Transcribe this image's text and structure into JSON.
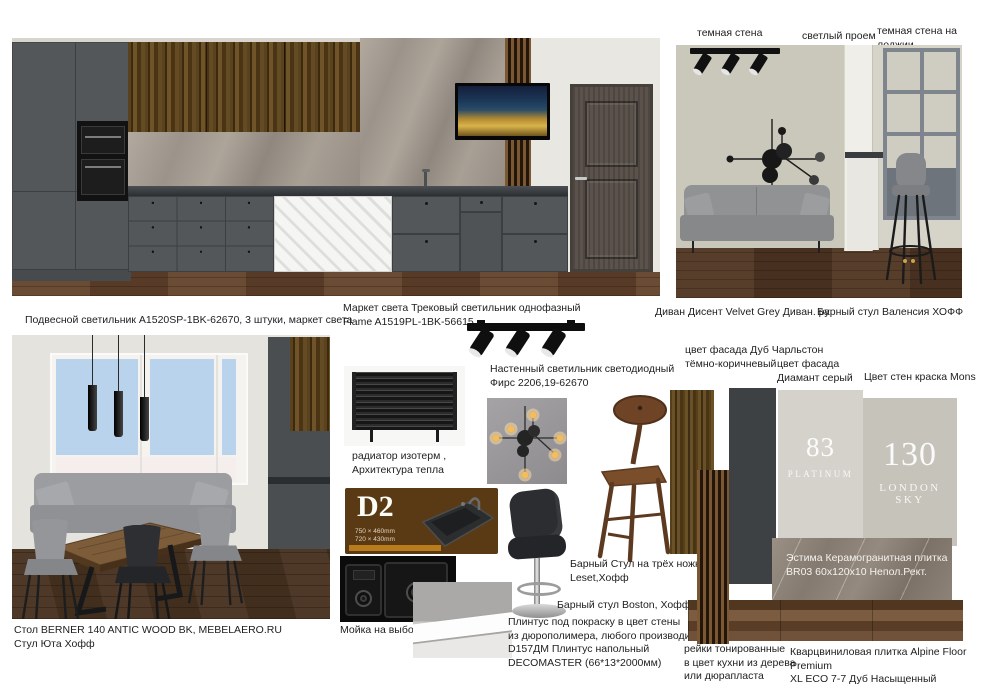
{
  "annotations": {
    "dark_wall": "темная стена",
    "light_opening": "светлый проем",
    "dark_wall_loggia": "темная стена на лоджии"
  },
  "captions": {
    "pendant_light": "Подвесной светильник A1520SP-1BK-62670, 3 штуки, маркет света",
    "track_light": "Маркет света Трековый светильник однофазный\nFlame A1519PL-1BK-56615",
    "sofa": "Диван Дисент Velvet Grey Диван. ру",
    "stool_valencia": "Барный стул Валенсия  ХОФФ",
    "wall_light": "Настенный светильник светодиодный\nФирс 2206,19-62670",
    "radiator": "радиатор изотерм ,\nАрхитектура тепла",
    "sink": "Мойка на выбор",
    "stool_leset": "Барный Стул на трёх ножках\nLeset,Хофф",
    "stool_boston": "Барный стул Boston, Хофф",
    "plinth": "Плинтус под покраску в цвет стены\nиз дюрополимера, любого производителя\nD157ДМ Плинтус напольный\nDECOMASTER (66*13*2000мм)",
    "table_and_chair": "Стол BERNER 140 ANTIC WOOD BK, MEBELAERO.RU\nСтул Юта Хофф",
    "slats": "рейки тонированные\nв цвет кухни из дерева\nили дюрапласта",
    "facade_oak": "цвет фасада Дуб Чарльстон\nтёмно-коричневый",
    "facade_gray": "цвет фасада\nДиамант серый",
    "wall_paint": "Цвет стен краска Mons",
    "tile": "Эстима Керамогранитная плитка\nBR03 60x120x10 Непол.Рект.",
    "vinyl": "Кварцвиниловая плитка Alpine Floor Premium\nXL ECO 7-7 Дуб Насыщенный"
  },
  "paint_samples": [
    {
      "number": "83",
      "name": "PLATINUM"
    },
    {
      "number": "130",
      "name": "LONDON SKY"
    }
  ],
  "sink_card": {
    "model": "D2",
    "size_line1": "750 × 460mm",
    "size_line2": "720 × 430mm"
  },
  "colors": {
    "cabinet_gray": "#54575a",
    "facade_dark_gray": "#3e4144",
    "wall_greige": "#cac7bb",
    "paint_platinum": "#d5d2cb",
    "paint_london_sky": "#c6c3ba",
    "sink_card_brown": "#5a3a14"
  }
}
